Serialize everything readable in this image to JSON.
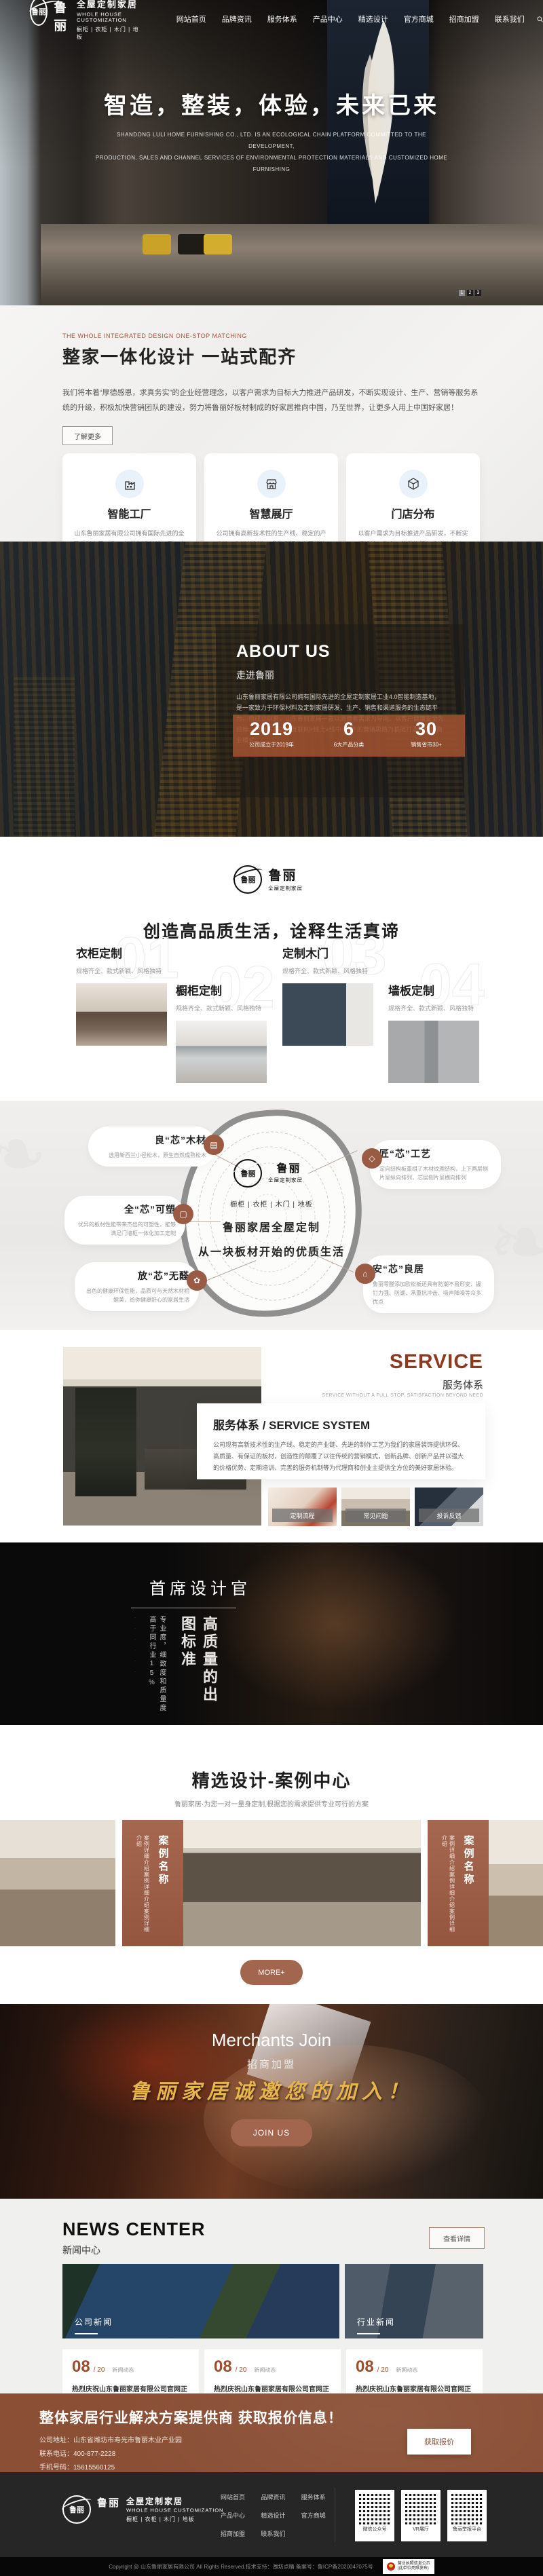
{
  "colors": {
    "accent_brown": "#9a5b44",
    "stats_overlay": "#9e5230",
    "gold": "#e8b44c",
    "service_red": "#8d3a22"
  },
  "brand": {
    "name_cn": "鲁丽",
    "full_cn": "全屋定制家居",
    "full_en": "WHOLE HOUSE CUSTOMIZATION",
    "tagline": "橱柜 | 衣柜 | 木门 | 地板"
  },
  "nav": {
    "items": [
      "网站首页",
      "品牌资讯",
      "服务体系",
      "产品中心",
      "精选设计",
      "官方商城",
      "招商加盟",
      "联系我们"
    ]
  },
  "hero": {
    "title": "智造，整装，体验，未来已来",
    "subtitle_line1": "SHANDONG LULI HOME FURNISHING CO., LTD. IS AN ECOLOGICAL CHAIN PLATFORM COMMITTED TO THE DEVELOPMENT,",
    "subtitle_line2": "PRODUCTION, SALES AND CHANNEL SERVICES OF ENVIRONMENTAL PROTECTION MATERIALS AND CUSTOMIZED HOME FURNISHING",
    "pagination": [
      "1",
      "2",
      "3"
    ]
  },
  "intro": {
    "eyebrow": "THE WHOLE INTEGRATED DESIGN ONE-STOP MATCHING",
    "title": "整家一体化设计  一站式配齐",
    "paragraph": "我们将本着“厚德感恩，求真务实”的企业经营理念，以客户需求为目标大力推进产品研发，不断实现设计、生产、营销等服务系统的升级，积极加快营销团队的建设，努力将鲁丽好板材制成的好家居推向中国，乃至世界，让更多人用上中国好家居！",
    "more_label": "了解更多",
    "cards": [
      {
        "title": "智能工厂",
        "text": "山东鲁丽家居有限公司拥有国际先进的全屋定制家居工业4.0智能制造基地，是一家致力于环保材料及定制家居研发、生产、销售和渠道服务的生态链平台。",
        "button": "了解更多"
      },
      {
        "title": "智慧展厅",
        "text": "公司拥有高新技术性的生产线、稳定的产业链、先进的制作工艺为我们的家居装饰提供环保、高质量、有保证的板材，创造性的颠覆了以往传统的营销模式",
        "button": "了解更多"
      },
      {
        "title": "门店分布",
        "text": "以客户需求为目标推进产品研发，不断实现设计、生产、营销等服务系统的升级，积极加快营销团队的建设，努力将鲁丽好板材制成的好家居推向中国，乃至世界，让更多人用上中国好家居！",
        "button": "了解更多"
      }
    ]
  },
  "about": {
    "title": "ABOUT US",
    "subtitle": "走进鲁丽",
    "paragraph": "山东鲁丽家居有限公司拥有国际先进的全屋定制家居工业4.0智能制造基地，是一家致力于环保材料及定制家居研发、生产、销售和渠道服务的生态链平台。自成立以来，山东鲁丽家居一直以消费者需求为导向、以客户健康安全为目标，应用IS2B2C+互联网+线上+线中+线下的营销思路为基础打造的全新商业模式。",
    "stats": [
      {
        "value": "2019",
        "label": "公司成立于2019年"
      },
      {
        "value": "6",
        "label": "6大产品分类"
      },
      {
        "value": "30",
        "label": "销售省市30+"
      }
    ]
  },
  "products": {
    "headline": "创造高品质生活，诠释生活真谛",
    "items": [
      {
        "num": "01",
        "title": "衣柜定制",
        "desc": "规格齐全、款式新颖、风格独特"
      },
      {
        "num": "02",
        "title": "橱柜定制",
        "desc": "规格齐全、款式新颖、风格独特"
      },
      {
        "num": "03",
        "title": "定制木门",
        "desc": "规格齐全、款式新颖、风格独特"
      },
      {
        "num": "04",
        "title": "墙板定制",
        "desc": "规格齐全、款式新颖、风格独特"
      }
    ]
  },
  "core": {
    "tags": "橱柜 | 衣柜 | 木门 | 地板",
    "line1": "鲁丽家居全屋定制",
    "line2": "从一块板材开始的优质生活",
    "callouts": [
      {
        "title": "良“芯”木材",
        "text": "选用新西兰小径松木，原生自然成熟松木"
      },
      {
        "title": "匠“芯”工艺",
        "text": "定向结构板重组了木材纹理结构，上下两层刨片呈纵向排列，芯层刨片呈横向排列"
      },
      {
        "title": "全“芯”可塑",
        "text": "优异的板材性能带来杰出的可塑性，能够满足门墙柜一体化加工定制"
      },
      {
        "title": "放“芯”无醛",
        "text": "出色的健康环保性能，品质可与天然木材相媲美，给你健康舒心的家居生活"
      },
      {
        "title": "安“芯”良居",
        "text": "鲁丽零醛添加欧松板还具有防潮不易形变、握钉力强、防潮、承重抗冲击、吸声降噪等众多优点"
      }
    ]
  },
  "service": {
    "title_en": "SERVICE",
    "title_cn": "服务体系",
    "tagline": "SERVICE WITHOUT A FULL STOP, SATISFACTION BEYOND NEED",
    "card_title": "服务体系 / SERVICE SYSTEM",
    "card_text": "公司现有高新技术性的生产线、稳定的产业链、先进的制作工艺为我们的家居装饰提供环保、高质量、有保证的板材，创造性的颠覆了以往传统的营销模式，创新品牌、创新产品并以强大的价格优势、定期培训、完善的服务机制等为代理商和创业主提供全方位的美好家居体验。",
    "links": [
      "定制流程",
      "常见问题",
      "投诉反馈"
    ]
  },
  "designer": {
    "title": "首席设计官",
    "vertical_main": "高质量的出图标准",
    "vertical_sub": "专业度，细致度和质量度高于同行业15%"
  },
  "cases": {
    "title": "精选设计-案例中心",
    "subtitle": "鲁丽家居·为您一对一量身定制,根据您的需求提供专业可行的方案",
    "card_title": "案例名称",
    "card_desc": "案例详细介绍案例详细介绍案例详细介绍",
    "more_label": "MORE+"
  },
  "join": {
    "title_en": "Merchants Join",
    "title_cn": "招商加盟",
    "calligraphy": "鲁丽家居诚邀您的加入！",
    "button": "JOIN US"
  },
  "news": {
    "title_en": "NEWS CENTER",
    "title_cn": "新闻中心",
    "detail_button": "查看详情",
    "label_left": "公司新闻",
    "label_right": "行业新闻",
    "items": [
      {
        "day": "08",
        "month": "/ 20",
        "tag": "新闻动态",
        "title": "热烈庆祝山东鲁丽家居有限公司官网正式上线！",
        "desc": "热烈庆祝山东鲁丽家居有限公司官网正式上线！"
      },
      {
        "day": "08",
        "month": "/ 20",
        "tag": "新闻动态",
        "title": "热烈庆祝山东鲁丽家居有限公司官网正式上线！",
        "desc": "热烈庆祝山东鲁丽家居有限公司官网正式上线！"
      },
      {
        "day": "08",
        "month": "/ 20",
        "tag": "新闻动态",
        "title": "热烈庆祝山东鲁丽家居有限公司官网正式上线！",
        "desc": "热烈庆祝山东鲁丽家居有限公司官网正式上线！"
      }
    ]
  },
  "cta": {
    "title": "整体家居行业解决方案提供商  获取报价信息！",
    "address": "公司地址：山东省潍坊市寿光市鲁丽木业产业园",
    "phone": "联系电话：400-877-2228",
    "mobile": "手机号码：15615560125",
    "button": "获取报价"
  },
  "footer": {
    "qrcodes": [
      "微信公众号",
      "VR展厅",
      "鲁丽举报平台"
    ],
    "copyright": "Copyright @ 山东鲁丽家居有限公司 All Rights Reserved.技术支持：潍坊点睛 备案号：鲁ICP备2020047075号",
    "badge_line1": "营业执照信息公示",
    "badge_line2": "(此单位亮照发布)"
  }
}
